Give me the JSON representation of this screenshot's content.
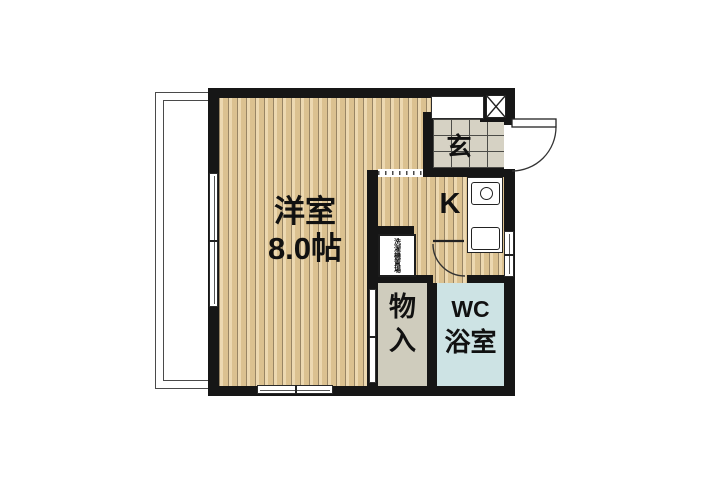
{
  "floor_plan": {
    "living_room": {
      "name": "洋室",
      "area": "8.0帖"
    },
    "kitchen": {
      "label": "K"
    },
    "entrance": {
      "label": "玄"
    },
    "closet": {
      "chars": [
        "物",
        "入"
      ]
    },
    "bathroom": {
      "lines": [
        "WC",
        "浴室"
      ]
    },
    "utility_box": {
      "label": "洗濯機置場"
    },
    "colors": {
      "wall": "#161616",
      "wood_floor": "#e8cf9e",
      "wood_stripe": "#745c34",
      "entrance_tile": "#d6d2c4",
      "closet_fill": "#cfccbd",
      "bath_fill": "#cde3e4",
      "background": "#ffffff"
    }
  }
}
